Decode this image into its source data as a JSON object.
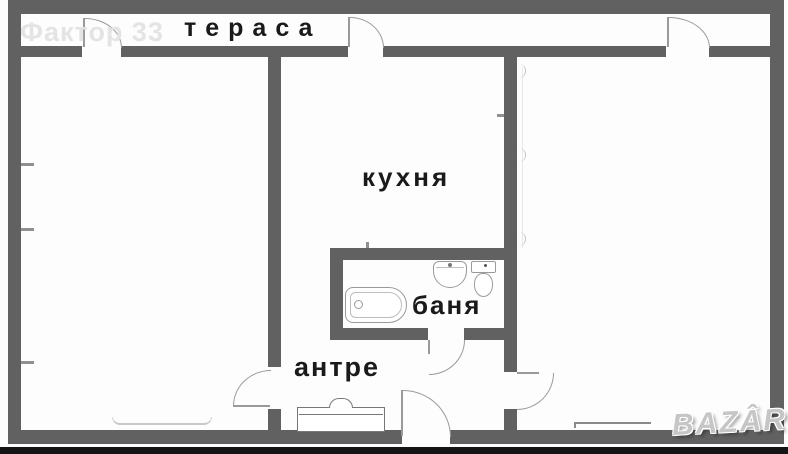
{
  "plan": {
    "rooms": {
      "terrace": {
        "label": "тераса"
      },
      "kitchen": {
        "label": "кухня"
      },
      "bathroom": {
        "label": "баня"
      },
      "hallway": {
        "label": "антре"
      }
    },
    "watermarks": {
      "top_left": "Фактор 33",
      "bottom_right": "BAZÂR"
    },
    "fixtures": [
      "bathtub",
      "sink",
      "toilet",
      "wardrobe",
      "radiator"
    ],
    "colors": {
      "wall": "#616161",
      "label_text": "#1a1a1a",
      "door_stroke": "#9a9a9a",
      "fixture_stroke": "#9a9a9a",
      "watermark_light": "#e4e4e4",
      "watermark_logo": "#c6c6c6",
      "bottom_bar": "#141414"
    }
  }
}
